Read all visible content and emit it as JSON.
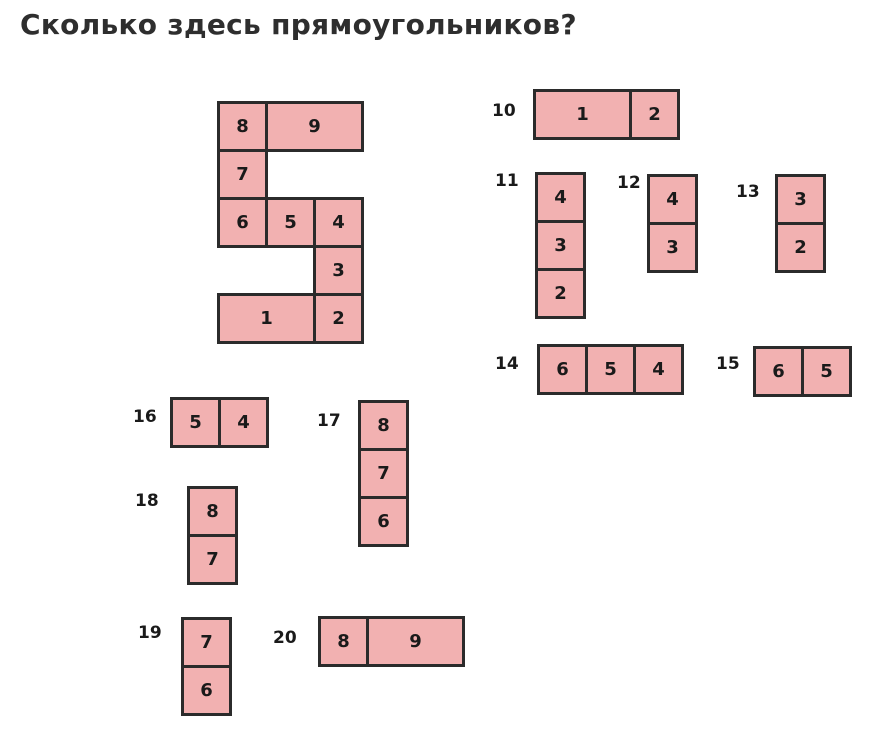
{
  "title": "Сколько здесь прямоугольников?",
  "colors": {
    "background": "#ffffff",
    "cell_fill": "#f2b1b1",
    "cell_border": "#2b2b2b",
    "number_text": "#1a1a1a",
    "title_text": "#2e2e2e"
  },
  "unit": 48,
  "border_px": 3,
  "figures": [
    {
      "id": "main",
      "label": "",
      "x": 217,
      "y": 101,
      "cells": [
        {
          "n": "8",
          "col": 0,
          "row": 0,
          "w": 1,
          "h": 1
        },
        {
          "n": "9",
          "col": 1,
          "row": 0,
          "w": 2,
          "h": 1
        },
        {
          "n": "7",
          "col": 0,
          "row": 1,
          "w": 1,
          "h": 1
        },
        {
          "n": "6",
          "col": 0,
          "row": 2,
          "w": 1,
          "h": 1
        },
        {
          "n": "5",
          "col": 1,
          "row": 2,
          "w": 1,
          "h": 1
        },
        {
          "n": "4",
          "col": 2,
          "row": 2,
          "w": 1,
          "h": 1
        },
        {
          "n": "3",
          "col": 2,
          "row": 3,
          "w": 1,
          "h": 1
        },
        {
          "n": "1",
          "col": 0,
          "row": 4,
          "w": 2,
          "h": 1
        },
        {
          "n": "2",
          "col": 2,
          "row": 4,
          "w": 1,
          "h": 1
        }
      ]
    },
    {
      "id": "10",
      "label": "10",
      "label_x": 492,
      "label_y": 103,
      "x": 533,
      "y": 89,
      "cells": [
        {
          "n": "1",
          "col": 0,
          "row": 0,
          "w": 2,
          "h": 1
        },
        {
          "n": "2",
          "col": 2,
          "row": 0,
          "w": 1,
          "h": 1
        }
      ]
    },
    {
      "id": "11",
      "label": "11",
      "label_x": 495,
      "label_y": 173,
      "x": 535,
      "y": 172,
      "cells": [
        {
          "n": "4",
          "col": 0,
          "row": 0,
          "w": 1,
          "h": 1
        },
        {
          "n": "3",
          "col": 0,
          "row": 1,
          "w": 1,
          "h": 1
        },
        {
          "n": "2",
          "col": 0,
          "row": 2,
          "w": 1,
          "h": 1
        }
      ]
    },
    {
      "id": "12",
      "label": "12",
      "label_x": 617,
      "label_y": 175,
      "x": 647,
      "y": 174,
      "cells": [
        {
          "n": "4",
          "col": 0,
          "row": 0,
          "w": 1,
          "h": 1
        },
        {
          "n": "3",
          "col": 0,
          "row": 1,
          "w": 1,
          "h": 1
        }
      ]
    },
    {
      "id": "13",
      "label": "13",
      "label_x": 736,
      "label_y": 184,
      "x": 775,
      "y": 174,
      "cells": [
        {
          "n": "3",
          "col": 0,
          "row": 0,
          "w": 1,
          "h": 1
        },
        {
          "n": "2",
          "col": 0,
          "row": 1,
          "w": 1,
          "h": 1
        }
      ]
    },
    {
      "id": "14",
      "label": "14",
      "label_x": 495,
      "label_y": 356,
      "x": 537,
      "y": 344,
      "cells": [
        {
          "n": "6",
          "col": 0,
          "row": 0,
          "w": 1,
          "h": 1
        },
        {
          "n": "5",
          "col": 1,
          "row": 0,
          "w": 1,
          "h": 1
        },
        {
          "n": "4",
          "col": 2,
          "row": 0,
          "w": 1,
          "h": 1
        }
      ]
    },
    {
      "id": "15",
      "label": "15",
      "label_x": 716,
      "label_y": 356,
      "x": 753,
      "y": 346,
      "cells": [
        {
          "n": "6",
          "col": 0,
          "row": 0,
          "w": 1,
          "h": 1
        },
        {
          "n": "5",
          "col": 1,
          "row": 0,
          "w": 1,
          "h": 1
        }
      ]
    },
    {
      "id": "16",
      "label": "16",
      "label_x": 133,
      "label_y": 409,
      "x": 170,
      "y": 397,
      "cells": [
        {
          "n": "5",
          "col": 0,
          "row": 0,
          "w": 1,
          "h": 1
        },
        {
          "n": "4",
          "col": 1,
          "row": 0,
          "w": 1,
          "h": 1
        }
      ]
    },
    {
      "id": "17",
      "label": "17",
      "label_x": 317,
      "label_y": 413,
      "x": 358,
      "y": 400,
      "cells": [
        {
          "n": "8",
          "col": 0,
          "row": 0,
          "w": 1,
          "h": 1
        },
        {
          "n": "7",
          "col": 0,
          "row": 1,
          "w": 1,
          "h": 1
        },
        {
          "n": "6",
          "col": 0,
          "row": 2,
          "w": 1,
          "h": 1
        }
      ]
    },
    {
      "id": "18",
      "label": "18",
      "label_x": 135,
      "label_y": 493,
      "x": 187,
      "y": 486,
      "cells": [
        {
          "n": "8",
          "col": 0,
          "row": 0,
          "w": 1,
          "h": 1
        },
        {
          "n": "7",
          "col": 0,
          "row": 1,
          "w": 1,
          "h": 1
        }
      ]
    },
    {
      "id": "19",
      "label": "19",
      "label_x": 138,
      "label_y": 625,
      "x": 181,
      "y": 617,
      "cells": [
        {
          "n": "7",
          "col": 0,
          "row": 0,
          "w": 1,
          "h": 1
        },
        {
          "n": "6",
          "col": 0,
          "row": 1,
          "w": 1,
          "h": 1
        }
      ]
    },
    {
      "id": "20",
      "label": "20",
      "label_x": 273,
      "label_y": 630,
      "x": 318,
      "y": 616,
      "cells": [
        {
          "n": "8",
          "col": 0,
          "row": 0,
          "w": 1,
          "h": 1
        },
        {
          "n": "9",
          "col": 1,
          "row": 0,
          "w": 2,
          "h": 1
        }
      ]
    }
  ]
}
